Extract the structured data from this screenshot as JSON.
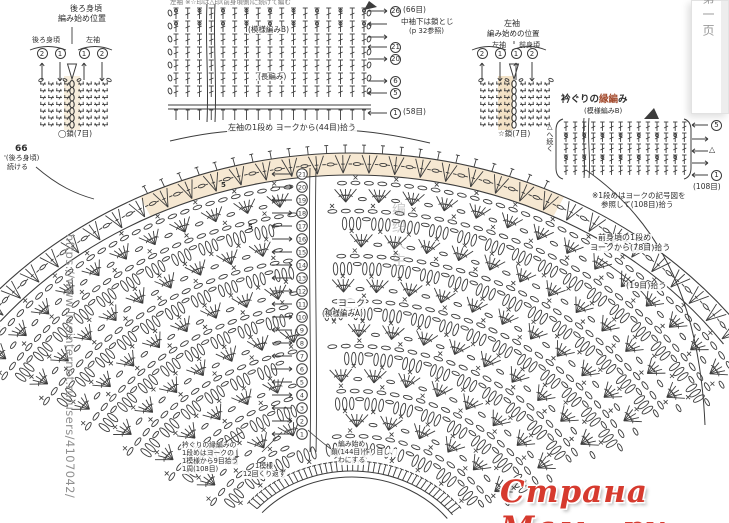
{
  "watermarks": {
    "url_vertical": "https://www.liveinternet.ru/users/4107042/",
    "site_logo": "Страна Мам . ру",
    "center_faint": "编织人生",
    "page_tab": "第一页"
  },
  "colors": {
    "ink": "#3c3c3c",
    "beige": "#f6e8d2",
    "accent_red": "#d63a2e",
    "title_red": "#a34b2e"
  },
  "back_chart": {
    "title_line1": "後ろ身頃",
    "title_line2": "編み始め位置",
    "col_left": "後ろ身頃",
    "col_right": "左袖",
    "order": [
      "2",
      "1",
      "1",
      "2"
    ],
    "order_dirs": [
      "up",
      "down",
      "up",
      "down"
    ],
    "chain_label": "◯鎖(7目)",
    "page_num": "66",
    "continue_line1": "'(後ろ身頃)",
    "continue_line2": "続ける"
  },
  "sleeve_chart": {
    "title_line1": "左袖",
    "title_line2": "編み始めの位置",
    "col_left": "左袖",
    "col_right": "前身頃",
    "order": [
      "2",
      "1",
      "1",
      "2"
    ],
    "order_dirs": [
      "up",
      "down",
      "up",
      "down"
    ],
    "chain_label": "☆鎖(7目)"
  },
  "sleeve_grid": {
    "clipped_note": "左袖 ※☆印は△印(前身頃側)に続けて編む",
    "pattern_b": "(模様編みB)",
    "dc_label": "(長編み)",
    "underarm_note1": "中袖下は鎖とじ",
    "underarm_note2": "(p 32参照)",
    "pickup_label": "左袖の1段め ヨークから(44目)拾う",
    "right_labels": [
      {
        "dir": "right",
        "num": "26",
        "text": "(66目)"
      },
      {
        "dir": "left",
        "num": "",
        "text": ""
      },
      {
        "dir": "right",
        "num": "",
        "text": ""
      },
      {
        "dir": "left",
        "num": "21",
        "text": ""
      },
      {
        "dir": "right",
        "num": "20",
        "text": ""
      },
      {
        "dir": "right",
        "num": "6",
        "text": ""
      },
      {
        "dir": "left",
        "num": "5",
        "text": ""
      },
      {
        "dir": "left",
        "num": "1",
        "text": "(58目)"
      }
    ]
  },
  "neck_edging": {
    "title_pre": "衿ぐりの",
    "title_mid": "縁編",
    "title_post": "み",
    "subtitle": "(模様編みB)",
    "continue_label": "△へ続く",
    "count_label": "(108目)",
    "note_line1": "※1段めはヨークの記号図を",
    "note_line2": "参照して(108目)拾う",
    "right_labels": [
      {
        "dir": "left",
        "label": "5",
        "circled": true
      },
      {
        "dir": "right",
        "label": "",
        "circled": false
      },
      {
        "dir": "left",
        "label": "△",
        "circled": false
      },
      {
        "dir": "right",
        "label": "",
        "circled": false
      },
      {
        "dir": "left",
        "label": "1",
        "circled": true
      }
    ]
  },
  "yoke": {
    "label_line1": "ヨーク",
    "label_line2": "(模様編みA)",
    "row_numbers": [
      "21",
      "20",
      "19",
      "18",
      "17",
      "16",
      "15",
      "14",
      "13",
      "12",
      "11",
      "10",
      "9",
      "8",
      "7",
      "6",
      "5",
      "4",
      "3",
      "2",
      "1"
    ],
    "front_pickup_line1": "前身頃の1段め",
    "front_pickup_line2": "ヨークから(78目)拾う",
    "pickup_19": "(19目)拾う",
    "start_note_line1": "編み始め",
    "start_note_line2": "鎖(144目)作り目し、",
    "start_note_line3": "わにする",
    "edging_note_line1": "衿ぐりの縁編みの",
    "edging_note_line2": "1段めはヨークの",
    "edging_note_line3": "1模様から9目拾う",
    "edging_note_line4": "1周(108目)",
    "repeat_note_line1": "1模様",
    "repeat_note_line2": "12回くり返す",
    "stitch_count_a": "5",
    "stitch_count_b": "5"
  }
}
